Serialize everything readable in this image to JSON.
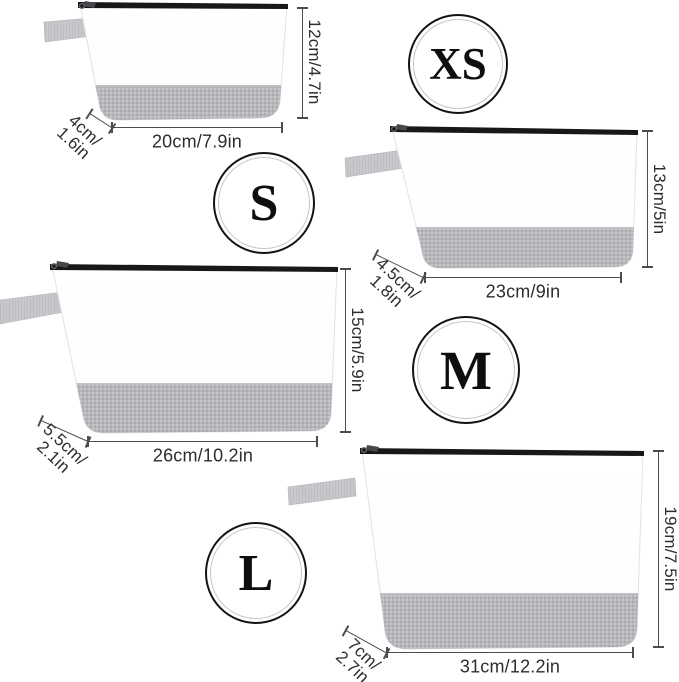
{
  "product_diagram": {
    "description_colors": {
      "background": "#ffffff",
      "bag_body": "#ffffff",
      "fabric_gray": "#b7b7bb",
      "tab_gray": "#c9c9cd",
      "zipper_black": "#18181a",
      "dimension_line": "#4c4c4c",
      "dimension_text": "#2d2d2d",
      "badge_ring_outer": "#141414",
      "badge_ring_inner": "#cfbed1"
    },
    "bags": [
      {
        "badge": "XS",
        "height_label": "12cm/4.7in",
        "width_label": "20cm/7.9in",
        "depth_lines": [
          "4cm/",
          "1.6in"
        ]
      },
      {
        "badge": "S",
        "height_label": "13cm/5in",
        "width_label": "23cm/9in",
        "depth_lines": [
          "4.5cm/",
          "1.8in"
        ]
      },
      {
        "badge": "M",
        "height_label": "15cm/5.9in",
        "width_label": "26cm/10.2in",
        "depth_lines": [
          "5.5cm/",
          "2.1in"
        ]
      },
      {
        "badge": "L",
        "height_label": "19cm/7.5in",
        "width_label": "31cm/12.2in",
        "depth_lines": [
          "7cm/",
          "2.7in"
        ]
      }
    ]
  }
}
